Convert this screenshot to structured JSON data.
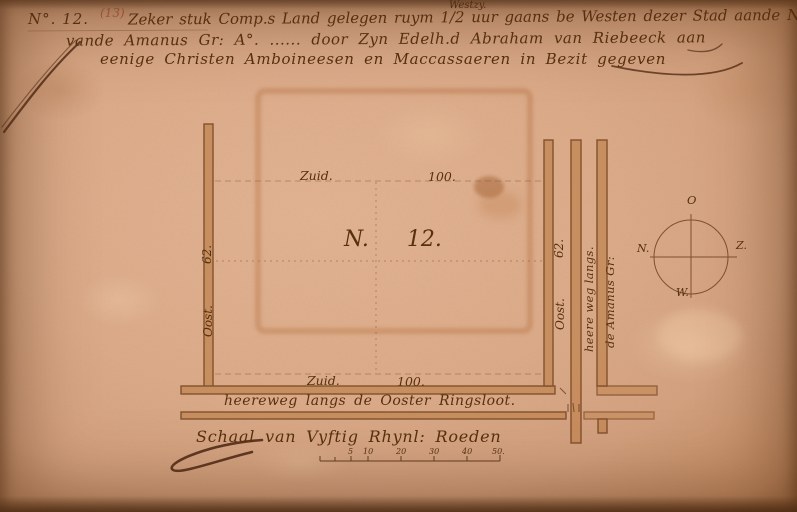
{
  "header": {
    "map_number": "N°. 12.",
    "alt_number": "(13)",
    "insertion": "Westzy.",
    "line1": "Zeker stuk Comp.s Land gelegen ruym 1/2 uur gaans be Westen dezer Stad aande Noord Zy",
    "line2": "vande Amanus Gr: A°. ...... door Zyn Edelh.d Abraham van Riebeeck aan",
    "line3": "eenige Christen Amboineesen en Maccassaeren in Bezit gegeven"
  },
  "plot": {
    "number_prefix": "N.",
    "number_value": "12.",
    "top_label": "Zuid.",
    "top_value": "100.",
    "bottom_label": "Zuid.",
    "bottom_value": "100.",
    "left_label": "Oost.",
    "left_value": "62.",
    "right_label": "Oost.",
    "right_value": "62."
  },
  "roads": {
    "bottom": "heereweg langs de Ooster Ringsloot.",
    "right_inner": "heere weg langs.",
    "right_outer": "de Amanus Gr:"
  },
  "compass": {
    "top": "O",
    "left": "N.",
    "right": "Z.",
    "bottom": "W."
  },
  "scale": {
    "label": "Schaal van Vyftig Rhynl: Roeden",
    "ticks": [
      "5",
      "10",
      "20",
      "30",
      "40",
      "50."
    ]
  },
  "colors": {
    "paper": "#dcab8a",
    "ink": "#57300f",
    "road_fill": "#c68c5c",
    "road_edge": "#7b4a26",
    "ghost": "#b06a38",
    "accent_red": "#bf5f3f"
  }
}
